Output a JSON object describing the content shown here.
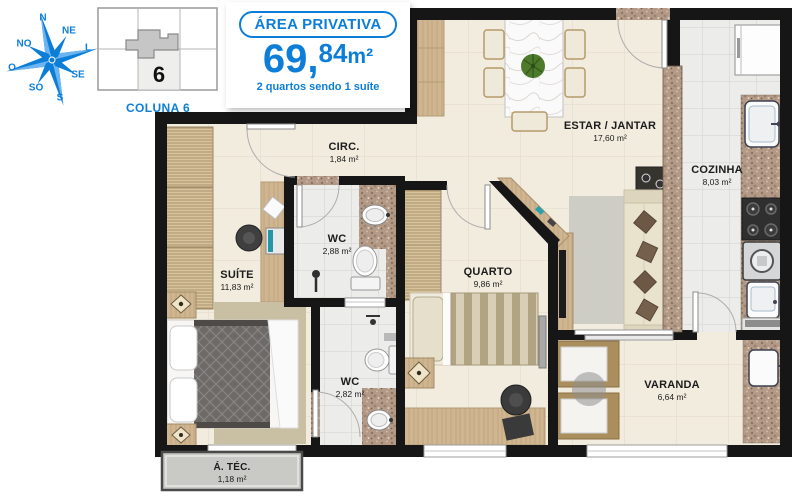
{
  "header": {
    "compass": {
      "n": "N",
      "ne": "NE",
      "e": "L",
      "se": "SE",
      "s": "S",
      "so": "SO",
      "o": "O",
      "no": "NO"
    },
    "keyplan": {
      "unit": "6",
      "caption": "COLUNA 6"
    },
    "badge": {
      "title": "ÁREA PRIVATIVA",
      "area_main": "69,",
      "area_sup": "84",
      "area_unit": "m²",
      "subtitle": "2 quartos sendo 1 suíte"
    }
  },
  "rooms": {
    "circ": {
      "name": "CIRC.",
      "area": "1,84 m²"
    },
    "wc_social": {
      "name": "WC",
      "area": "2,88 m²"
    },
    "suite": {
      "name": "SUÍTE",
      "area": "11,83 m²"
    },
    "quarto": {
      "name": "QUARTO",
      "area": "9,86 m²"
    },
    "estar": {
      "name": "ESTAR / JANTAR",
      "area": "17,60 m²"
    },
    "cozinha": {
      "name": "COZINHA",
      "area": "8,03 m²"
    },
    "wc_suite": {
      "name": "WC",
      "area": "2,82 m²"
    },
    "varanda": {
      "name": "VARANDA",
      "area": "6,64 m²"
    },
    "area_tecnica": {
      "name": "Á. TÉC.",
      "area": "1,18 m²"
    }
  },
  "colors": {
    "accent": "#0d7ed8",
    "wall": "#161616",
    "floor_cream": "#f2ecdf",
    "floor_tile": "#ececeb",
    "granite": "#b29a86",
    "wood": "#cfb691",
    "atec_gray": "#c9c9c5"
  }
}
